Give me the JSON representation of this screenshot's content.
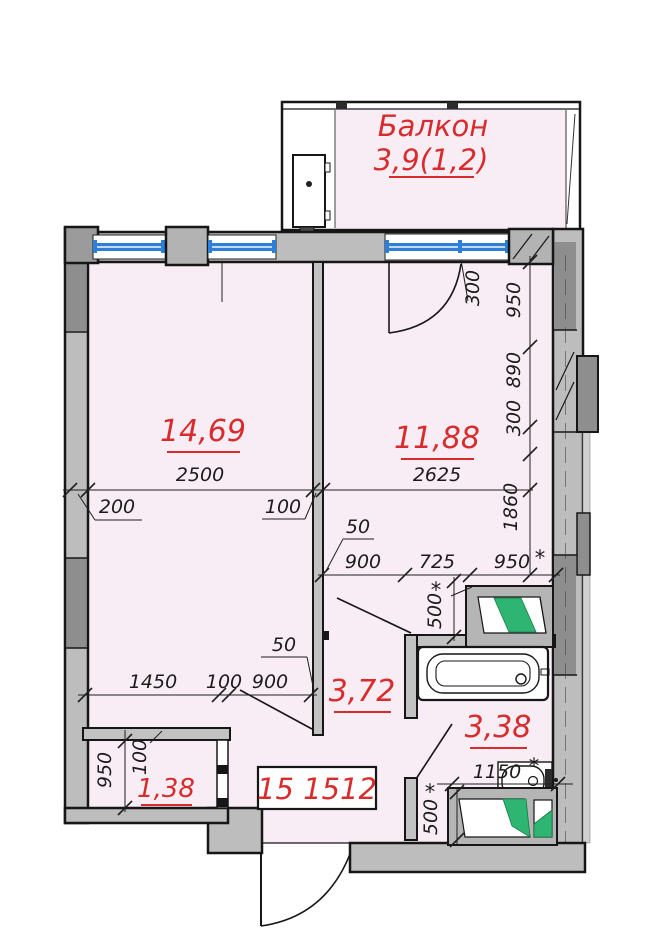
{
  "balcony": {
    "label": "Балкон",
    "area": "3,9(1,2)"
  },
  "rooms": {
    "room1": {
      "area": "14,69"
    },
    "room2": {
      "area": "11,88"
    },
    "hall": {
      "area": "3,72"
    },
    "bath": {
      "area": "3,38"
    },
    "wc": {
      "area": "1,38"
    }
  },
  "plan_code": "15 1512",
  "dims": {
    "w_room1": "2500",
    "w_room2": "2625",
    "wall_left": "200",
    "partition": "100",
    "door_gap": "300",
    "seg_950": "950",
    "seg_890": "890",
    "seg_300": "300",
    "seg_1860": "1860",
    "gap50_top": "50",
    "hall_w": "900",
    "mid_w": "725",
    "bath_w": "950",
    "vent_top": "500",
    "gap50_bot": "50",
    "wc_w": "1450",
    "wc_wall": "100",
    "door_w": "900",
    "wc_h": "950",
    "wc_wall2": "100",
    "toilet_w": "1150",
    "vent_bot": "500",
    "star": "*"
  },
  "colors": {
    "floor": "#f8edf5",
    "wall": "#bdbdbd",
    "wall_dark": "#8e8e8e",
    "accent_red": "#d92b2b",
    "window_blue": "#2e7fd8",
    "fixture_green": "#2eb571"
  }
}
